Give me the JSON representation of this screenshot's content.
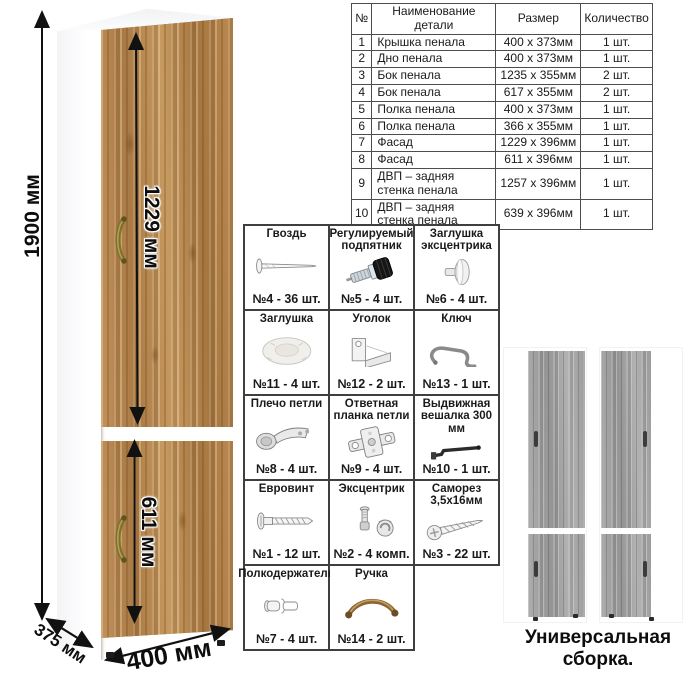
{
  "cabinet": {
    "dim_height": "1900 мм",
    "dim_upper_door": "1229 мм",
    "dim_lower_door": "611 мм",
    "dim_width": "400 мм",
    "dim_depth": "375 мм"
  },
  "colors": {
    "wood": "#b6854e",
    "gray_wood": "#a2a2a2",
    "handle_bronze": "#7d6f2e",
    "dimension_line": "#111111",
    "table_border": "#4d4d4d"
  },
  "parts_table": {
    "headers": [
      "№",
      "Наименование детали",
      "Размер",
      "Количество"
    ],
    "rows": [
      {
        "num": "1",
        "name": "Крышка пенала",
        "size": "400 x 373мм",
        "qty": "1 шт."
      },
      {
        "num": "2",
        "name": "Дно пенала",
        "size": "400 x 373мм",
        "qty": "1 шт."
      },
      {
        "num": "3",
        "name": "Бок пенала",
        "size": "1235 x 355мм",
        "qty": "2 шт."
      },
      {
        "num": "4",
        "name": "Бок пенала",
        "size": "617 x 355мм",
        "qty": "2 шт."
      },
      {
        "num": "5",
        "name": "Полка пенала",
        "size": "400 x 373мм",
        "qty": "1 шт."
      },
      {
        "num": "6",
        "name": "Полка пенала",
        "size": "366 x 355мм",
        "qty": "1 шт."
      },
      {
        "num": "7",
        "name": "Фасад",
        "size": "1229 x 396мм",
        "qty": "1 шт."
      },
      {
        "num": "8",
        "name": "Фасад",
        "size": "611 x 396мм",
        "qty": "1 шт."
      },
      {
        "num": "9",
        "name": "ДВП – задняя стенка пенала",
        "size": "1257 x 396мм",
        "qty": "1 шт."
      },
      {
        "num": "10",
        "name": "ДВП – задняя стенка пенала",
        "size": "639 x 396мм",
        "qty": "1 шт."
      }
    ]
  },
  "hardware": {
    "items": [
      {
        "title": "Гвоздь",
        "label": "№4 - 36 шт.",
        "icon": "nail-icon"
      },
      {
        "title": "Регулируемый подпятник",
        "label": "№5 - 4 шт.",
        "icon": "adjustable-foot-icon"
      },
      {
        "title": "Заглушка эксцентрика",
        "label": "№6 - 4 шт.",
        "icon": "cam-cover-icon"
      },
      {
        "title": "Заглушка",
        "label": "№11 - 4 шт.",
        "icon": "cap-icon"
      },
      {
        "title": "Уголок",
        "label": "№12 - 2 шт.",
        "icon": "corner-bracket-icon"
      },
      {
        "title": "Ключ",
        "label": "№13 - 1 шт.",
        "icon": "key-icon"
      },
      {
        "title": "Плечо петли",
        "label": "№8 - 4 шт.",
        "icon": "hinge-arm-icon"
      },
      {
        "title": "Ответная планка петли",
        "label": "№9 - 4 шт.",
        "icon": "hinge-plate-icon"
      },
      {
        "title": "Выдвижная вешалка 300 мм",
        "label": "№10 - 1 шт.",
        "icon": "pullout-hanger-icon"
      },
      {
        "title": "Евровинт",
        "label": "№1 - 12 шт.",
        "icon": "euroscrew-icon"
      },
      {
        "title": "Эксцентрик",
        "label": "№2 - 4 комп.",
        "icon": "cam-lock-icon"
      },
      {
        "title": "Саморез 3,5х16мм",
        "label": "№3 - 22 шт.",
        "icon": "screw-icon"
      },
      {
        "title": "Полкодержатель",
        "label": "№7 - 4 шт.",
        "icon": "shelf-pin-icon"
      },
      {
        "title": "Ручка",
        "label": "№14 - 2 шт.",
        "icon": "handle-icon"
      }
    ]
  },
  "assembly": {
    "caption": "Универсальная сборка."
  }
}
